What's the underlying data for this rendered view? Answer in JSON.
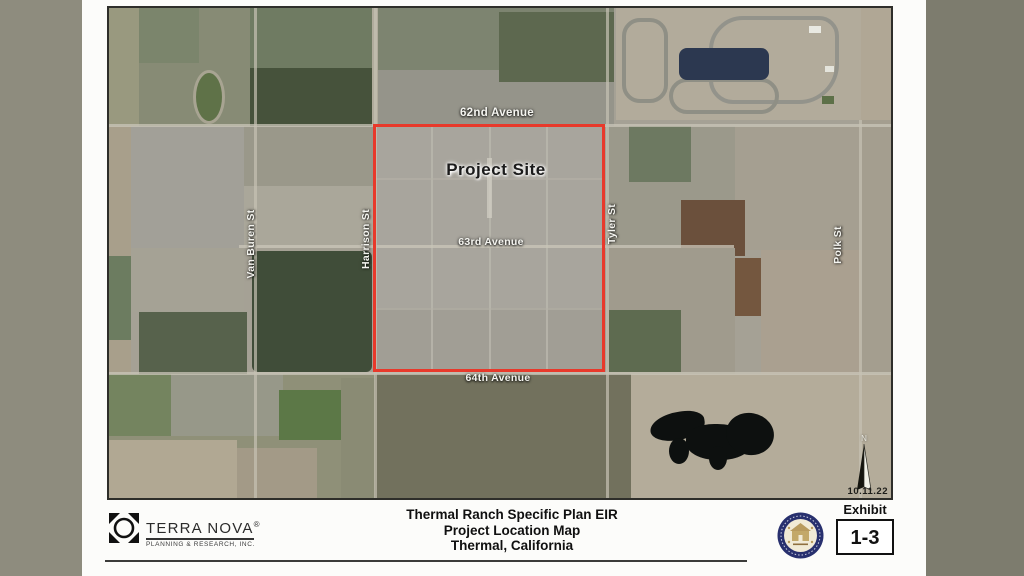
{
  "map": {
    "labels": {
      "avenue_62": "62nd Avenue",
      "avenue_63": "63rd Avenue",
      "avenue_64": "64th Avenue",
      "van_buren": "Van Buren St",
      "harrison": "Harrison St",
      "tyler": "Tyler St",
      "polk": "Polk St",
      "project_site": "Project Site",
      "date": "10.11.22",
      "north_letter": "N"
    },
    "boundary_color": "#e8392b"
  },
  "footer": {
    "logo": {
      "name": "TERRA NOVA",
      "registered": "®",
      "tagline": "PLANNING & RESEARCH, INC."
    },
    "title_lines": [
      "Thermal Ranch Specific Plan EIR",
      "Project Location Map",
      "Thermal, California"
    ],
    "exhibit_label": "Exhibit",
    "exhibit_number": "1-3"
  }
}
